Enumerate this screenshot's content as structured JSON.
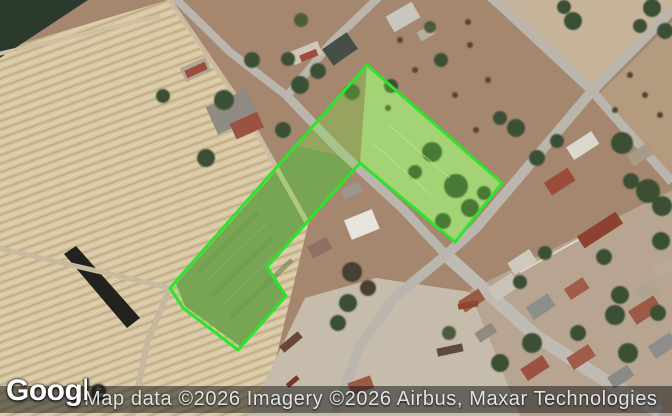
{
  "map": {
    "view_type": "satellite",
    "parcel_highlight": {
      "points": "367,65 502,183 455,242 360,163 267,267 286,296 238,350 183,308 170,288",
      "outline_color": "#2de42d",
      "fill_color": "rgba(124,228,68,0.32)"
    }
  },
  "attribution": {
    "text": "Map data ©2026 Imagery ©2026 Airbus, Maxar Technologies"
  },
  "logo": {
    "text": "Google"
  }
}
